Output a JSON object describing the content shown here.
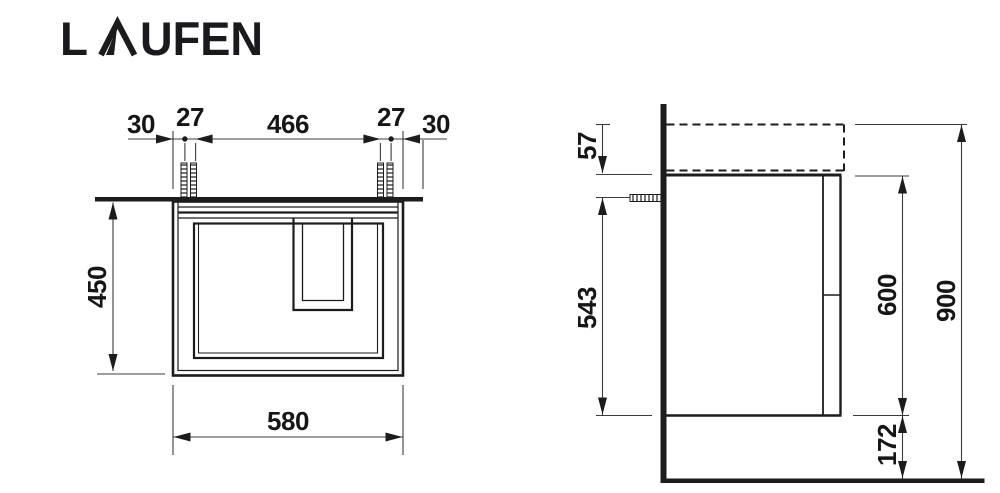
{
  "brand": {
    "logo_full": "LAUFEN",
    "logo_l": "L",
    "logo_rest": "UFEN"
  },
  "front_view": {
    "title": "front view of vanity unit",
    "top_dims": [
      "30",
      "27",
      "466",
      "27",
      "30"
    ],
    "height": "450",
    "width": "580"
  },
  "side_view": {
    "title": "side view of vanity unit",
    "basin_overlap_height": "57",
    "screw_to_bottom": "543",
    "cabinet_height": "600",
    "overall_height": "900",
    "floor_clearance": "172"
  },
  "colors": {
    "line": "#1c1c1f",
    "thin_line": "#3c3c40",
    "background": "#ffffff"
  }
}
